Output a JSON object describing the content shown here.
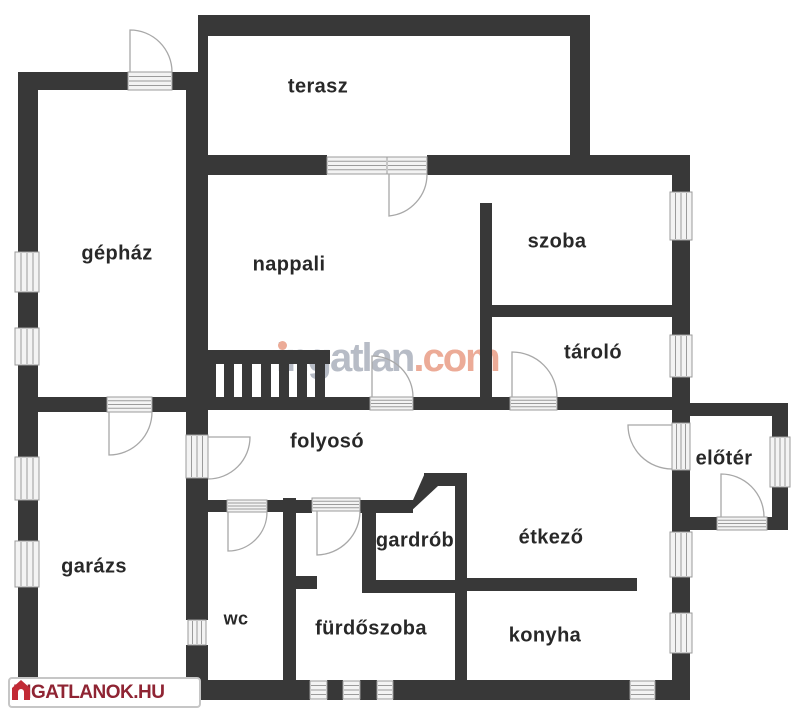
{
  "watermark": {
    "brand": "ingatlan",
    "tld": ".com",
    "brand_color": "#b7bcc6",
    "tld_color": "#ecab97"
  },
  "logo": {
    "text": "INGATLANOK.HU",
    "text_color": "#8f2433",
    "house_color": "#c22a35"
  },
  "rooms": {
    "terasz": "terasz",
    "gephaz": "gépház",
    "nappali": "nappali",
    "szoba": "szoba",
    "tarolo": "tároló",
    "folyoso": "folyosó",
    "eloter": "előtér",
    "garazs": "garázs",
    "gardrob": "gardrób",
    "etkezo": "étkező",
    "wc": "wc",
    "furdoszoba": "fürdőszoba",
    "konyha": "konyha"
  },
  "colors": {
    "wall": "#383838",
    "window_fill": "#f3f3f3",
    "window_line": "#9b9b9b",
    "door_arc": "#a8a8a8",
    "background": "#ffffff",
    "label": "#282828"
  }
}
